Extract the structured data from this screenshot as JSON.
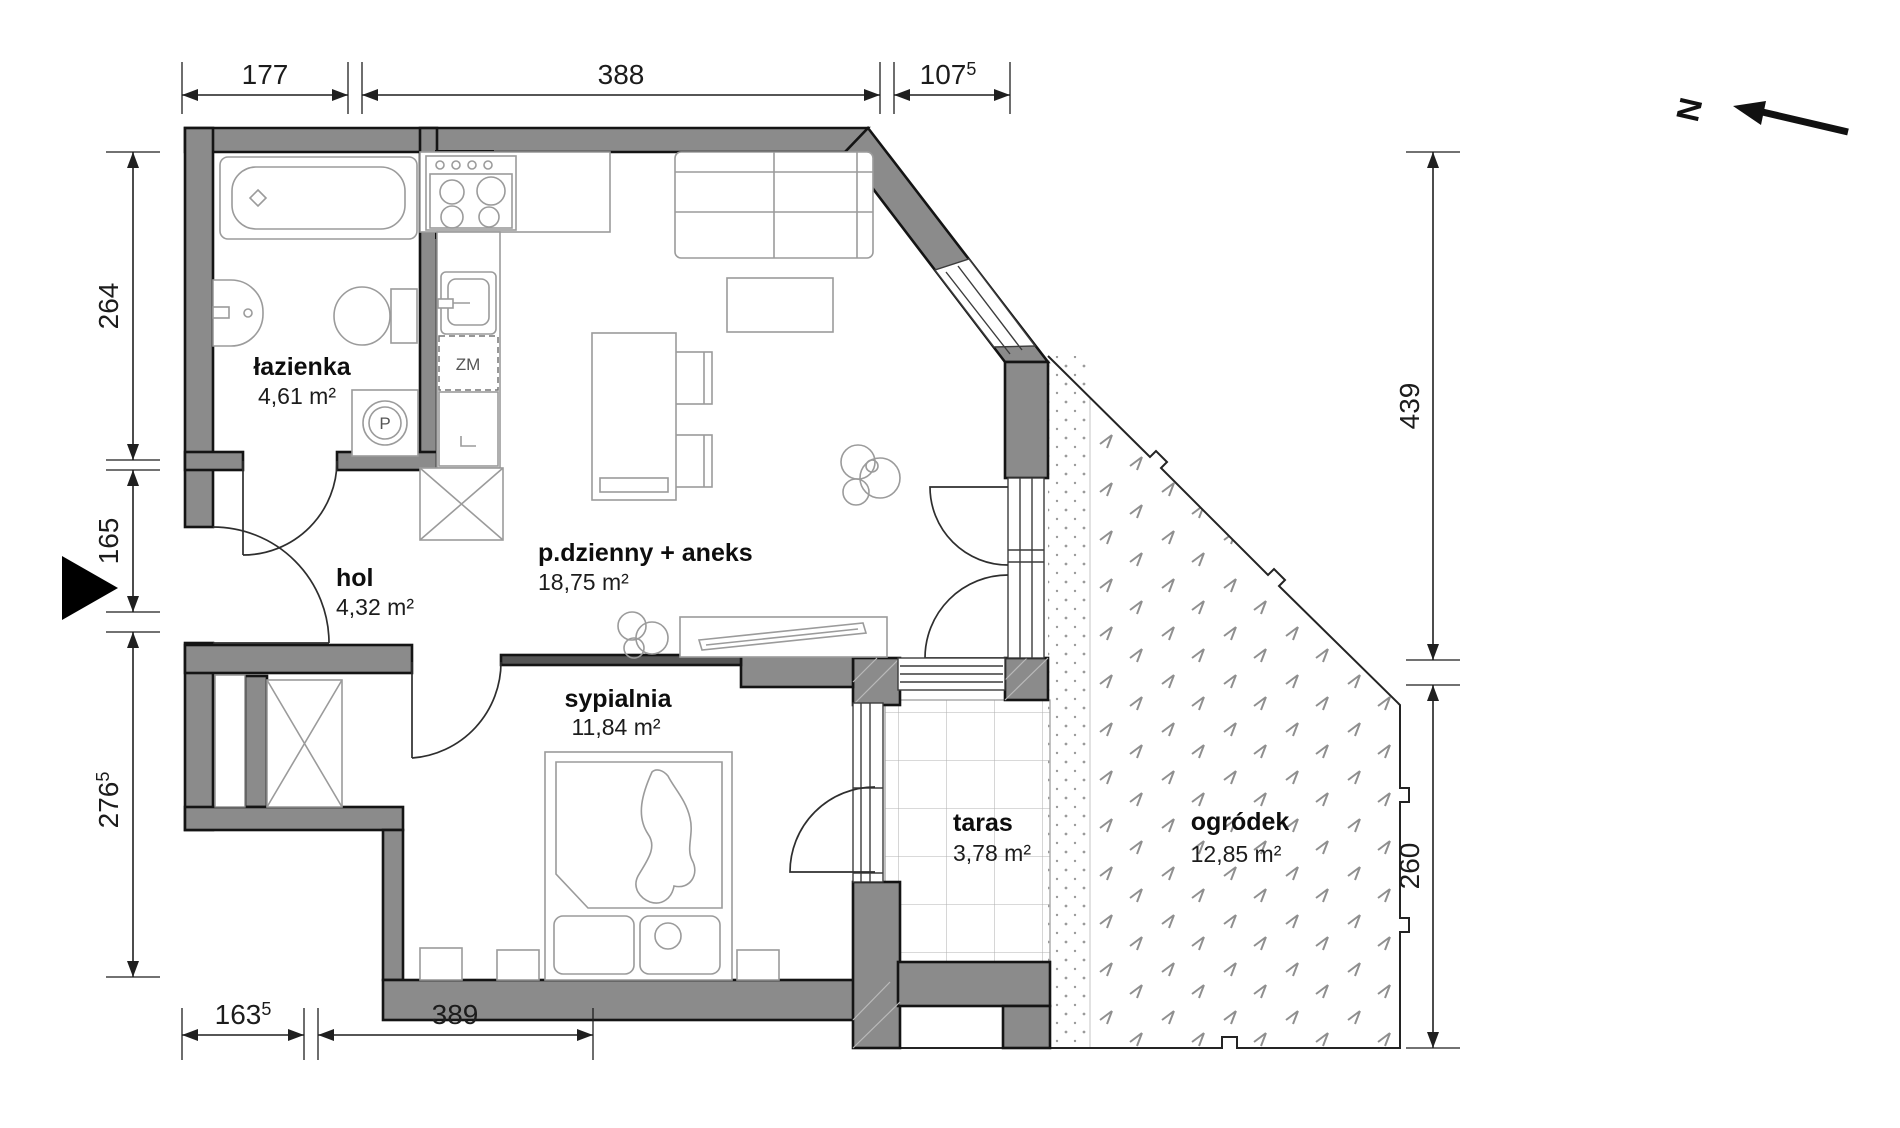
{
  "rooms": {
    "bathroom": {
      "name": "łazienka",
      "area": "4,61 m²"
    },
    "hall": {
      "name": "hol",
      "area": "4,32 m²"
    },
    "living": {
      "name": "p.dzienny + aneks",
      "area": "18,75 m²"
    },
    "bedroom": {
      "name": "sypialnia",
      "area": "11,84 m²"
    },
    "terrace": {
      "name": "taras",
      "area": "3,78 m²"
    },
    "garden": {
      "name": "ogródek",
      "area": "12,85 m²"
    }
  },
  "dims": {
    "top": {
      "d1": "177",
      "d2": "388",
      "d3": "107",
      "d3_sup": "5"
    },
    "bottom": {
      "d1": "163",
      "d1_sup": "5",
      "d2": "389"
    },
    "left": {
      "d1": "264",
      "d2": "165",
      "d3": "276",
      "d3_sup": "5"
    },
    "right": {
      "d1": "439",
      "d2": "260"
    }
  },
  "symbols": {
    "north": "N",
    "washing_machine": "P",
    "dishwasher": "ZM"
  },
  "colors": {
    "wall": "#8b8b8b",
    "partition": "#555555",
    "outline": "#141414"
  }
}
